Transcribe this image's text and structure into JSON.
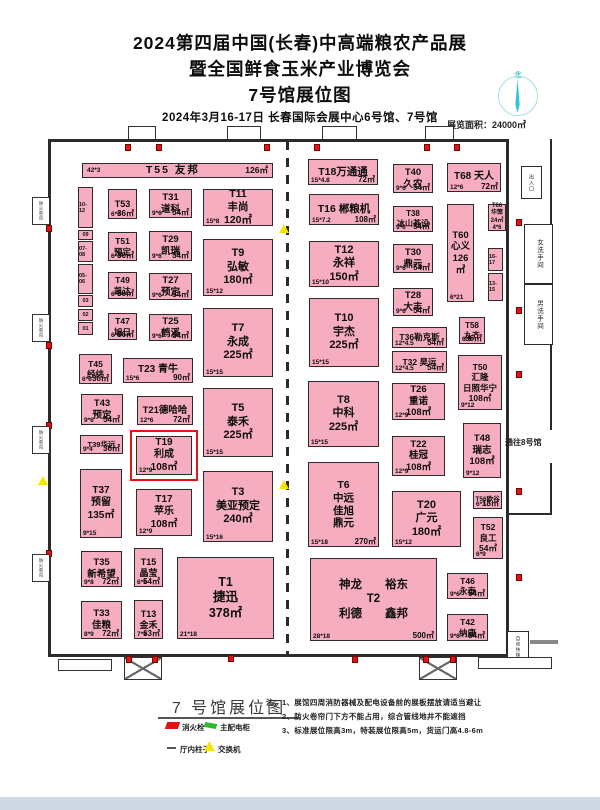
{
  "header": {
    "title_line1": "2024第四届中国(长春)中高端粮农产品展",
    "title_line2": "暨全国鲜食玉米产业博览会",
    "title_line3": "7号馆展位图",
    "subtitle": "2024年3月16-17日  长春国际会展中心6号馆、7号馆",
    "area_label": "展览面积：24000㎡",
    "compass_north": "北"
  },
  "plan": {
    "labels": {
      "to_hall8": "通往8号馆",
      "restroom_women": "女洗手间",
      "restroom_men": "男洗手间",
      "escalator": "自动扶梯",
      "fire_shutter": "防火卷帘",
      "entrance": "出入口"
    },
    "booths": [
      {
        "id": "T55",
        "bar": true,
        "lines": [
          "T55  友邦"
        ],
        "bl": "42*3",
        "br": "126㎡",
        "x": 82,
        "y": 163,
        "w": 191,
        "h": 15
      },
      {
        "id": "T53",
        "lines": [
          "T53"
        ],
        "bl": "6*6",
        "br": "36㎡",
        "x": 108,
        "y": 189,
        "w": 29,
        "h": 30,
        "fs": 9
      },
      {
        "id": "T31",
        "lines": [
          "T31",
          "道科"
        ],
        "bl": "9*6",
        "br": "54㎡",
        "x": 149,
        "y": 189,
        "w": 43,
        "h": 29,
        "fs": 9.5
      },
      {
        "id": "T11",
        "lines": [
          "T11",
          "丰尚",
          "120㎡"
        ],
        "bl": "15*8",
        "x": 203,
        "y": 189,
        "w": 70,
        "h": 37,
        "fs": 10.5
      },
      {
        "id": "T51",
        "lines": [
          "T51",
          "预定"
        ],
        "bl": "6*6",
        "br": "36㎡",
        "x": 108,
        "y": 232,
        "w": 29,
        "h": 29,
        "fs": 8.5
      },
      {
        "id": "T29",
        "lines": [
          "T29",
          "凯瑞"
        ],
        "bl": "9*6",
        "br": "54㎡",
        "x": 149,
        "y": 231,
        "w": 43,
        "h": 30,
        "fs": 9.5
      },
      {
        "id": "T9",
        "lines": [
          "T9",
          "弘敏",
          "180㎡"
        ],
        "bl": "15*12",
        "x": 203,
        "y": 239,
        "w": 70,
        "h": 57,
        "fs": 11
      },
      {
        "id": "T49",
        "lines": [
          "T49",
          "凯达"
        ],
        "bl": "6*6",
        "br": "36㎡",
        "x": 108,
        "y": 272,
        "w": 29,
        "h": 27,
        "fs": 8.5
      },
      {
        "id": "T27",
        "lines": [
          "T27",
          "预定"
        ],
        "bl": "9*6",
        "br": "54㎡",
        "x": 149,
        "y": 273,
        "w": 43,
        "h": 27,
        "fs": 9.5
      },
      {
        "id": "T47",
        "lines": [
          "T47",
          "旭日"
        ],
        "bl": "6*6",
        "br": "36㎡",
        "x": 108,
        "y": 313,
        "w": 29,
        "h": 27,
        "fs": 8.5
      },
      {
        "id": "T25",
        "lines": [
          "T25",
          "鹤溪"
        ],
        "bl": "9*6",
        "br": "54㎡",
        "x": 149,
        "y": 314,
        "w": 43,
        "h": 27,
        "fs": 9.5
      },
      {
        "id": "T7",
        "lines": [
          "T7",
          "永成",
          "225㎡"
        ],
        "bl": "15*15",
        "x": 203,
        "y": 308,
        "w": 70,
        "h": 69,
        "fs": 11
      },
      {
        "id": "T45",
        "lines": [
          "T45",
          "经纬"
        ],
        "bl": "6*6",
        "br": "36㎡",
        "x": 79,
        "y": 354,
        "w": 33,
        "h": 30,
        "fs": 8.5
      },
      {
        "id": "T23",
        "lines": [
          "T23 青牛"
        ],
        "bl": "15*6",
        "br": "90㎡",
        "x": 123,
        "y": 358,
        "w": 70,
        "h": 25,
        "fs": 10
      },
      {
        "id": "T43",
        "lines": [
          "T43",
          "预定"
        ],
        "bl": "9*6",
        "br": "54㎡",
        "x": 81,
        "y": 394,
        "w": 42,
        "h": 31,
        "fs": 9.5
      },
      {
        "id": "T21",
        "lines": [
          "T21德哈哈"
        ],
        "bl": "12*6",
        "br": "72㎡",
        "x": 137,
        "y": 396,
        "w": 56,
        "h": 29,
        "fs": 9.5
      },
      {
        "id": "T5",
        "lines": [
          "T5",
          "泰禾",
          "225㎡"
        ],
        "bl": "15*15",
        "x": 203,
        "y": 388,
        "w": 70,
        "h": 69,
        "fs": 11
      },
      {
        "id": "T39",
        "lines": [
          "T39华远"
        ],
        "bl": "9*4",
        "br": "36㎡",
        "x": 80,
        "y": 435,
        "w": 43,
        "h": 19,
        "fs": 7.5
      },
      {
        "id": "T19",
        "hl": true,
        "lines": [
          "T19",
          "利成",
          "108㎡"
        ],
        "bl": "12*9",
        "x": 136,
        "y": 436,
        "w": 56,
        "h": 39,
        "fs": 10
      },
      {
        "id": "T37",
        "lines": [
          "T37",
          "预留",
          "135㎡"
        ],
        "bl": "9*15",
        "x": 80,
        "y": 469,
        "w": 42,
        "h": 69,
        "fs": 10
      },
      {
        "id": "T17",
        "lines": [
          "T17",
          "苹乐",
          "108㎡"
        ],
        "bl": "12*9",
        "x": 136,
        "y": 489,
        "w": 56,
        "h": 47,
        "fs": 10
      },
      {
        "id": "T3",
        "lines": [
          "T3",
          "美亚预定",
          "240㎡"
        ],
        "bl": "15*16",
        "x": 203,
        "y": 471,
        "w": 70,
        "h": 71,
        "fs": 11
      },
      {
        "id": "T35",
        "lines": [
          "T35",
          "新希望"
        ],
        "bl": "9*8",
        "br": "72㎡",
        "x": 81,
        "y": 551,
        "w": 41,
        "h": 36,
        "fs": 9.5
      },
      {
        "id": "T15",
        "lines": [
          "T15",
          "晶莹"
        ],
        "bl": "6*9",
        "br": "54㎡",
        "x": 134,
        "y": 548,
        "w": 29,
        "h": 39,
        "fs": 9
      },
      {
        "id": "T1",
        "lines": [
          "T1",
          "捷迅",
          "378㎡"
        ],
        "bl": "21*18",
        "x": 177,
        "y": 557,
        "w": 97,
        "h": 82,
        "fs": 12.5
      },
      {
        "id": "T33",
        "lines": [
          "T33",
          "佳粮"
        ],
        "bl": "8*9",
        "br": "72㎡",
        "x": 81,
        "y": 601,
        "w": 41,
        "h": 38,
        "fs": 9.5
      },
      {
        "id": "T13",
        "lines": [
          "T13",
          "金禾"
        ],
        "bl": "7*9",
        "br": "63㎡",
        "x": 134,
        "y": 600,
        "w": 29,
        "h": 39,
        "fs": 9
      },
      {
        "id": "T18",
        "lines": [
          "T18万通通"
        ],
        "bl": "15*4.8",
        "br": "72㎡",
        "x": 308,
        "y": 159,
        "w": 70,
        "h": 26,
        "fs": 10.5
      },
      {
        "id": "T40",
        "lines": [
          "T40",
          "久农"
        ],
        "bl": "9*6",
        "br": "54㎡",
        "x": 393,
        "y": 164,
        "w": 40,
        "h": 29,
        "fs": 9.5
      },
      {
        "id": "T68",
        "lines": [
          "T68 天人"
        ],
        "bl": "12*6",
        "br": "72㎡",
        "x": 447,
        "y": 163,
        "w": 54,
        "h": 29,
        "fs": 10
      },
      {
        "id": "T16",
        "lines": [
          "T16 郴粮机"
        ],
        "bl": "15*7.2",
        "br": "108㎡",
        "x": 309,
        "y": 194,
        "w": 70,
        "h": 31,
        "fs": 10.5
      },
      {
        "id": "T38",
        "lines": [
          "T38",
          "冰山荟设"
        ],
        "bl": "9*6",
        "br": "54㎡",
        "x": 393,
        "y": 206,
        "w": 40,
        "h": 26,
        "fs": 8
      },
      {
        "id": "T66",
        "lines": [
          "T66",
          "华策",
          "24㎡",
          "4*6"
        ],
        "x": 488,
        "y": 204,
        "w": 18,
        "h": 27,
        "fs": 6
      },
      {
        "id": "T60",
        "lines": [
          "T60",
          "心义",
          "126㎡"
        ],
        "bl": "6*21",
        "x": 447,
        "y": 204,
        "w": 27,
        "h": 98,
        "fs": 9.5
      },
      {
        "id": "T12",
        "lines": [
          "T12",
          "永祥",
          "150㎡"
        ],
        "bl": "15*10",
        "x": 309,
        "y": 241,
        "w": 70,
        "h": 46,
        "fs": 11
      },
      {
        "id": "T30",
        "lines": [
          "T30",
          "鼎元"
        ],
        "bl": "9*6",
        "br": "54㎡",
        "x": 393,
        "y": 244,
        "w": 40,
        "h": 29,
        "fs": 9.5
      },
      {
        "id": "T28",
        "lines": [
          "T28",
          "大丰"
        ],
        "bl": "9*6",
        "br": "54㎡",
        "x": 393,
        "y": 288,
        "w": 40,
        "h": 28,
        "fs": 9.5
      },
      {
        "id": "T10",
        "lines": [
          "T10",
          "宇杰",
          "225㎡"
        ],
        "bl": "15*15",
        "x": 309,
        "y": 298,
        "w": 70,
        "h": 69,
        "fs": 11
      },
      {
        "id": "T58",
        "lines": [
          "T58",
          "九齐"
        ],
        "bl": "6*6",
        "br": "36㎡",
        "x": 459,
        "y": 317,
        "w": 26,
        "h": 27,
        "fs": 8
      },
      {
        "id": "T36",
        "lines": [
          "T36勒克斯"
        ],
        "bl": "12*4.5",
        "br": "54㎡",
        "x": 392,
        "y": 327,
        "w": 55,
        "h": 21,
        "fs": 8.5
      },
      {
        "id": "T32",
        "lines": [
          "T32 昊运"
        ],
        "bl": "12*4.5",
        "br": "54㎡",
        "x": 392,
        "y": 351,
        "w": 55,
        "h": 22,
        "fs": 8.5
      },
      {
        "id": "T50",
        "lines": [
          "T50",
          "汇隆",
          "日照华宁",
          "108㎡"
        ],
        "bl": "9*12",
        "x": 458,
        "y": 355,
        "w": 44,
        "h": 55,
        "fs": 8.5
      },
      {
        "id": "T8",
        "lines": [
          "T8",
          "中科",
          "225㎡"
        ],
        "bl": "15*15",
        "x": 308,
        "y": 381,
        "w": 71,
        "h": 66,
        "fs": 11
      },
      {
        "id": "T26",
        "lines": [
          "T26",
          "重诺",
          "108㎡"
        ],
        "bl": "12*9",
        "x": 392,
        "y": 383,
        "w": 53,
        "h": 37,
        "fs": 9.5
      },
      {
        "id": "T22",
        "lines": [
          "T22",
          "桂冠",
          "108㎡"
        ],
        "bl": "12*9",
        "x": 392,
        "y": 436,
        "w": 53,
        "h": 40,
        "fs": 9.5
      },
      {
        "id": "T48",
        "lines": [
          "T48",
          "瑞志",
          "108㎡"
        ],
        "bl": "9*12",
        "x": 463,
        "y": 423,
        "w": 38,
        "h": 55,
        "fs": 9.5
      },
      {
        "id": "T6",
        "lines": [
          "T6",
          "中远",
          "佳旭",
          "鼎元"
        ],
        "bl": "15*18",
        "br": "270㎡",
        "x": 308,
        "y": 462,
        "w": 71,
        "h": 85,
        "fs": 10.5
      },
      {
        "id": "T56",
        "lines": [
          "T56欧谷"
        ],
        "bl": "6*3",
        "br": "18㎡",
        "x": 473,
        "y": 491,
        "w": 29,
        "h": 18,
        "fs": 6.5
      },
      {
        "id": "T20",
        "lines": [
          "T20",
          "广元",
          "180㎡"
        ],
        "bl": "15*12",
        "x": 392,
        "y": 491,
        "w": 69,
        "h": 56,
        "fs": 11
      },
      {
        "id": "T52",
        "lines": [
          "T52",
          "良工",
          "54㎡"
        ],
        "bl": "6*9",
        "x": 473,
        "y": 517,
        "w": 30,
        "h": 42,
        "fs": 8.5
      },
      {
        "id": "T2",
        "lines": [
          "神龙　　裕东",
          "T2",
          "利德　　鑫邦"
        ],
        "bl": "28*18",
        "br": "500㎡",
        "x": 310,
        "y": 558,
        "w": 127,
        "h": 83,
        "fs": 11.5
      },
      {
        "id": "T46",
        "lines": [
          "T46",
          "永泰"
        ],
        "bl": "9*6",
        "br": "54㎡",
        "x": 447,
        "y": 573,
        "w": 41,
        "h": 26,
        "fs": 8.5
      },
      {
        "id": "T42",
        "lines": [
          "T42",
          "纳康"
        ],
        "bl": "9*6",
        "br": "54㎡",
        "x": 447,
        "y": 614,
        "w": 41,
        "h": 27,
        "fs": 8.5
      }
    ],
    "left_strip": {
      "x": 78,
      "y": 187,
      "w": 15,
      "cells": [
        {
          "t": "10-12",
          "h": 41
        },
        {
          "t": "09",
          "h": 10
        },
        {
          "t": "07-08",
          "h": 21
        },
        {
          "t": "05-06",
          "h": 30
        },
        {
          "t": "03",
          "h": 12
        },
        {
          "t": "02",
          "h": 12
        },
        {
          "t": "01",
          "h": 13
        }
      ]
    },
    "right_strip": {
      "x": 488,
      "y": 248,
      "w": 15,
      "cells": [
        {
          "t": "16-17",
          "h": 23
        },
        {
          "t": "13-15",
          "h": 28
        }
      ]
    },
    "hydrants": [
      [
        125,
        144
      ],
      [
        156,
        144
      ],
      [
        264,
        144
      ],
      [
        314,
        144
      ],
      [
        424,
        144
      ],
      [
        454,
        144
      ],
      [
        46,
        225
      ],
      [
        46,
        342
      ],
      [
        46,
        422
      ],
      [
        46,
        550
      ],
      [
        126,
        656
      ],
      [
        152,
        656
      ],
      [
        228,
        655
      ],
      [
        352,
        656
      ],
      [
        423,
        656
      ],
      [
        450,
        656
      ],
      [
        516,
        219
      ],
      [
        516,
        307
      ],
      [
        516,
        371
      ],
      [
        516,
        488
      ],
      [
        516,
        574
      ]
    ],
    "switches": [
      [
        279,
        224
      ],
      [
        279,
        480
      ],
      [
        38,
        476
      ]
    ],
    "left_doors_y": [
      197,
      314,
      426,
      554
    ],
    "top_doors": [
      [
        128,
        28
      ],
      [
        227,
        34
      ],
      [
        322,
        35
      ],
      [
        425,
        29
      ]
    ]
  },
  "footer": {
    "plan_title": "7 号馆展位图",
    "legend": [
      {
        "icon": "hydrant-icon",
        "label": "消火栓"
      },
      {
        "icon": "power-cabinet-icon",
        "label": "主配电柜"
      },
      {
        "icon": "pillar-icon",
        "label": "厅内柱子"
      },
      {
        "icon": "switch-icon",
        "label": "交换机"
      }
    ],
    "notes_label": "注：",
    "notes": [
      "1、展馆四周消防器械及配电设备前的展板摆放请适当避让",
      "2、防火卷帘门下方不能占用，综合管线地井不能遮挡",
      "3、标准展位限高3m，特装展位限高5m，货运门高4.8-6m"
    ]
  }
}
